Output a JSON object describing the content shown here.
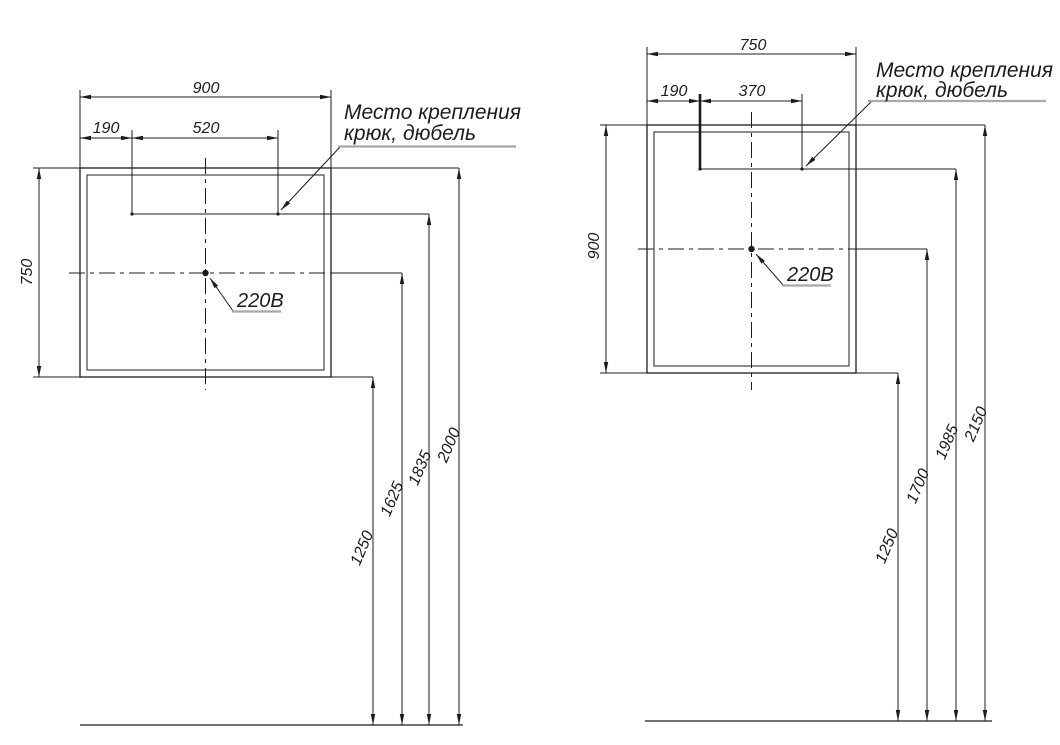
{
  "views": {
    "left": {
      "overall_width": "900",
      "hook_edge_offset": "190",
      "hook_spacing": "520",
      "panel_height": "750",
      "mount_note_line1": "Место крепления",
      "mount_note_line2": "крюк, дюбель",
      "outlet_label": "220В",
      "heights_from_floor": {
        "bottom": "1250",
        "outlet": "1625",
        "hook": "1835",
        "top": "2000"
      }
    },
    "right": {
      "overall_width": "750",
      "hook_edge_offset": "190",
      "hook_spacing": "370",
      "panel_height": "900",
      "mount_note_line1": "Место крепления",
      "mount_note_line2": "крюк, дюбель",
      "outlet_label": "220В",
      "heights_from_floor": {
        "bottom": "1250",
        "outlet": "1700",
        "hook": "1985",
        "top": "2150"
      }
    }
  },
  "colors": {
    "line": "#1c1c1c",
    "leader_underline": "#a8a8a8",
    "background": "#ffffff"
  }
}
